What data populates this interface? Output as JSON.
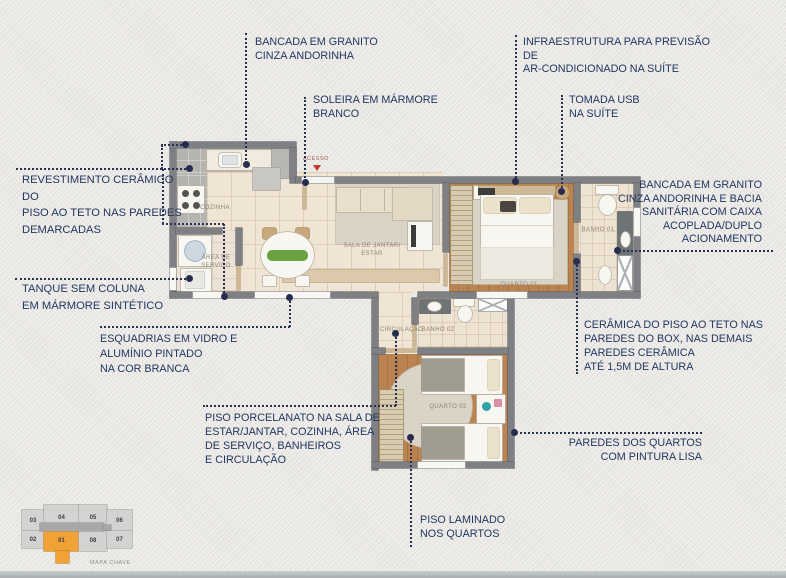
{
  "colors": {
    "callout_text": "#223760",
    "connector": "#2b3154",
    "wall": "#7e8083",
    "accent_orange": "#f0a236",
    "acesso_red": "#c13b30"
  },
  "callouts": [
    {
      "id": "bancada-granito-cozinha",
      "text": "BANCADA EM GRANITO\nCINZA ANDORINHA"
    },
    {
      "id": "soleira-marmore",
      "text": "SOLEIRA EM MÁRMORE\nBRANCO"
    },
    {
      "id": "infra-ar-condicionado",
      "text": "INFRAESTRUTURA PARA PREVISÃO DE\nAR-CONDICIONADO NA SUÍTE"
    },
    {
      "id": "tomada-usb",
      "text": "TOMADA USB\nNA SUÍTE"
    },
    {
      "id": "bancada-granito-banho",
      "text": "BANCADA EM GRANITO\nCINZA ANDORINHA E BACIA\nSANITÁRIA COM CAIXA\nACOPLADA/DUPLO\nACIONAMENTO"
    },
    {
      "id": "ceramica-box",
      "text": "CERÂMICA DO PISO AO TETO NAS\nPAREDES DO BOX, NAS DEMAIS\nPAREDES CERÂMICA\nATÉ 1,5M DE ALTURA"
    },
    {
      "id": "revestimento-ceramico",
      "text": "REVESTIMENTO CERÂMICO DO\nPISO AO TETO NAS PAREDES\nDEMARCADAS"
    },
    {
      "id": "tanque-sem-coluna",
      "text": "TANQUE SEM COLUNA\nEM MÁRMORE SINTÉTICO"
    },
    {
      "id": "esquadrias",
      "text": "ESQUADRIAS EM VIDRO E\nALUMÍNIO PINTADO\nNA COR BRANCA"
    },
    {
      "id": "piso-porcelanato",
      "text": "PISO PORCELANATO NA SALA DE\nESTAR/JANTAR, COZINHA, ÁREA\nDE SERVIÇO, BANHEIROS\nE CIRCULAÇÃO"
    },
    {
      "id": "piso-laminado",
      "text": "PISO LAMINADO\nNOS QUARTOS"
    },
    {
      "id": "paredes-quartos",
      "text": "PAREDES DOS QUARTOS\nCOM PINTURA LISA"
    }
  ],
  "plan": {
    "entrance_label": "ACESSO",
    "rooms": [
      {
        "id": "cozinha",
        "label": "COZINHA"
      },
      {
        "id": "area-servico",
        "label": "ÁREA DE\nSERVIÇO"
      },
      {
        "id": "sala",
        "label": "SALA DE JANTAR/\nESTAR"
      },
      {
        "id": "quarto-01",
        "label": "QUARTO 01"
      },
      {
        "id": "banho-01",
        "label": "BANHO 01"
      },
      {
        "id": "circulacao",
        "label": "CIRCULAÇÃO"
      },
      {
        "id": "banho-02",
        "label": "BANHO 02"
      },
      {
        "id": "quarto-02",
        "label": "QUARTO 02"
      }
    ]
  },
  "keymap": {
    "caption": "MAPA CHAVE",
    "highlighted_unit": "01",
    "units": [
      {
        "number": "03"
      },
      {
        "number": "04"
      },
      {
        "number": "05"
      },
      {
        "number": "06"
      },
      {
        "number": "02"
      },
      {
        "number": "01"
      },
      {
        "number": "08"
      },
      {
        "number": "07"
      }
    ]
  }
}
